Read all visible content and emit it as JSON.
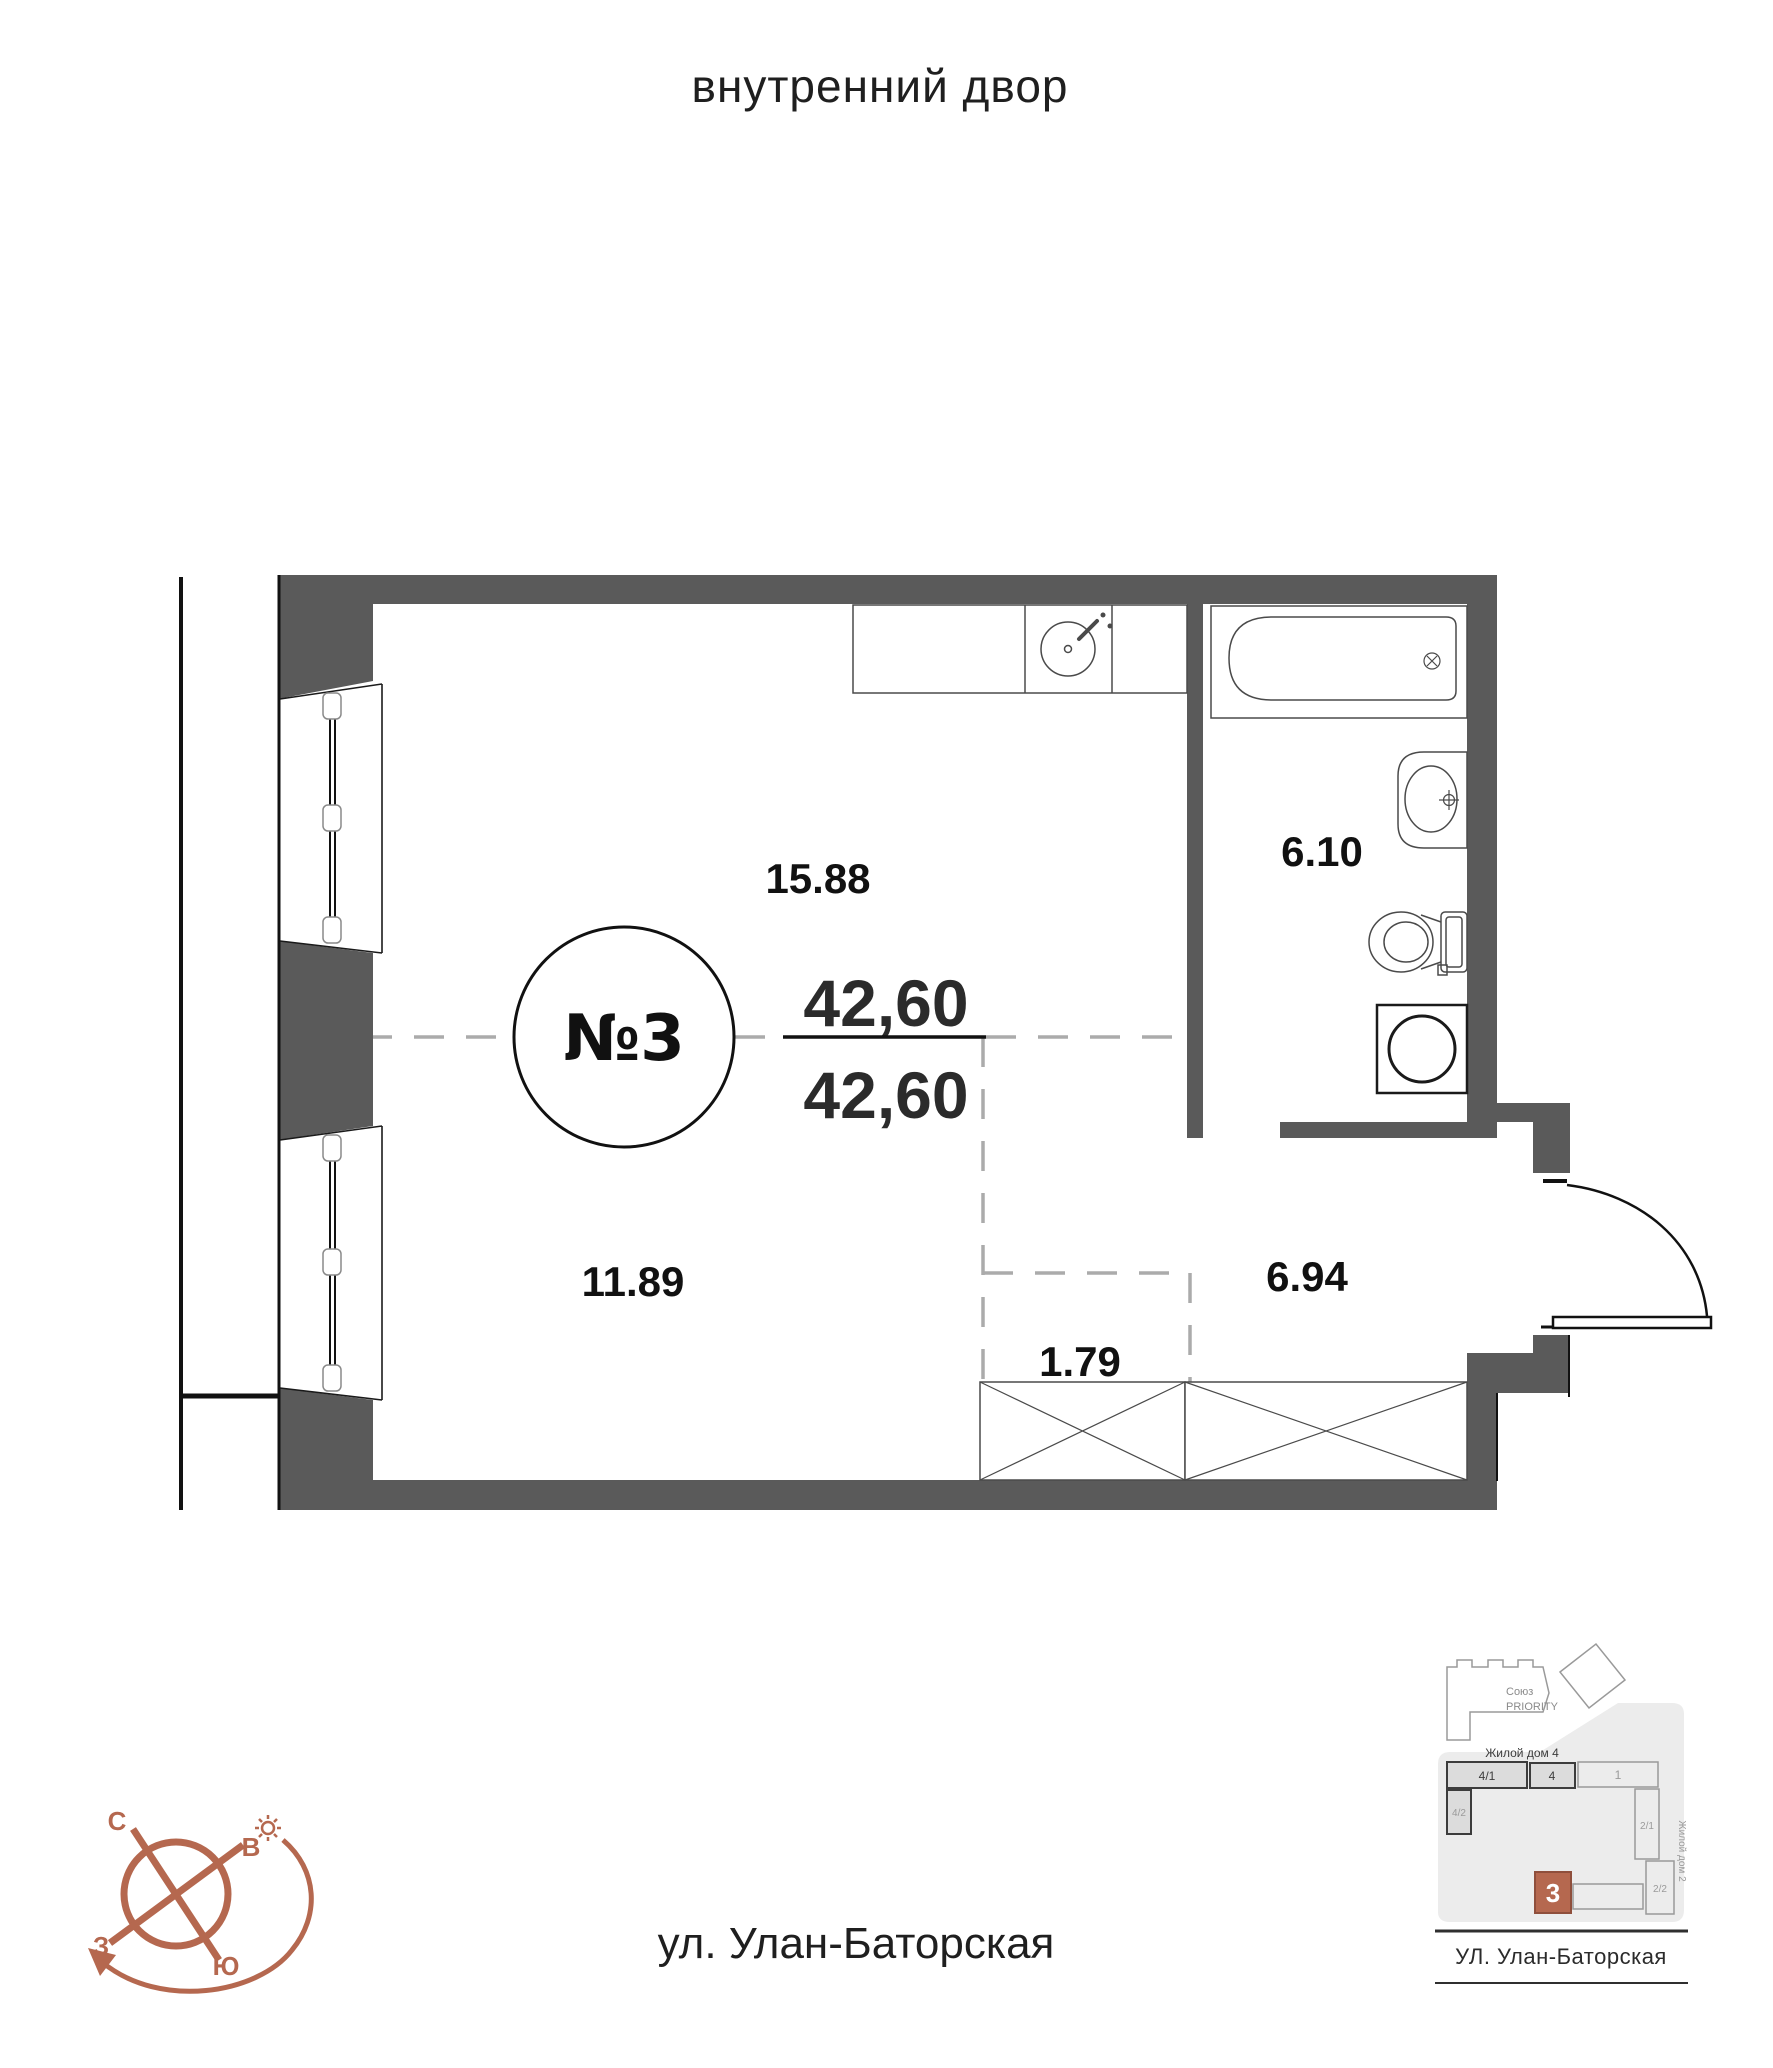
{
  "title": "внутренний двор",
  "street_label": "ул. Улан-Баторская",
  "plan": {
    "apartment_number": "№3",
    "total_area": "42,60",
    "living_area": "42,60",
    "areas": {
      "kitchen_living": "15.88",
      "bathroom": "6.10",
      "room": "11.89",
      "hallway": "6.94",
      "wardrobe": "1.79"
    }
  },
  "compass": {
    "north": "С",
    "east": "В",
    "west": "З",
    "south": "Ю"
  },
  "minimap": {
    "complex_name_line1": "Союз",
    "complex_name_line2": "PRIORITY",
    "building4_label": "Жилой дом 4",
    "building2_label": "Жилой дом 2",
    "street": "УЛ. Улан-Баторская",
    "blocks": {
      "b41": "4/1",
      "b4": "4",
      "b1": "1",
      "b42": "4/2",
      "b21": "2/1",
      "b22": "2/2",
      "b3": "3"
    }
  },
  "colors": {
    "wall": "#5a5a5a",
    "accent": "#b5684f",
    "dash": "#ababab"
  }
}
